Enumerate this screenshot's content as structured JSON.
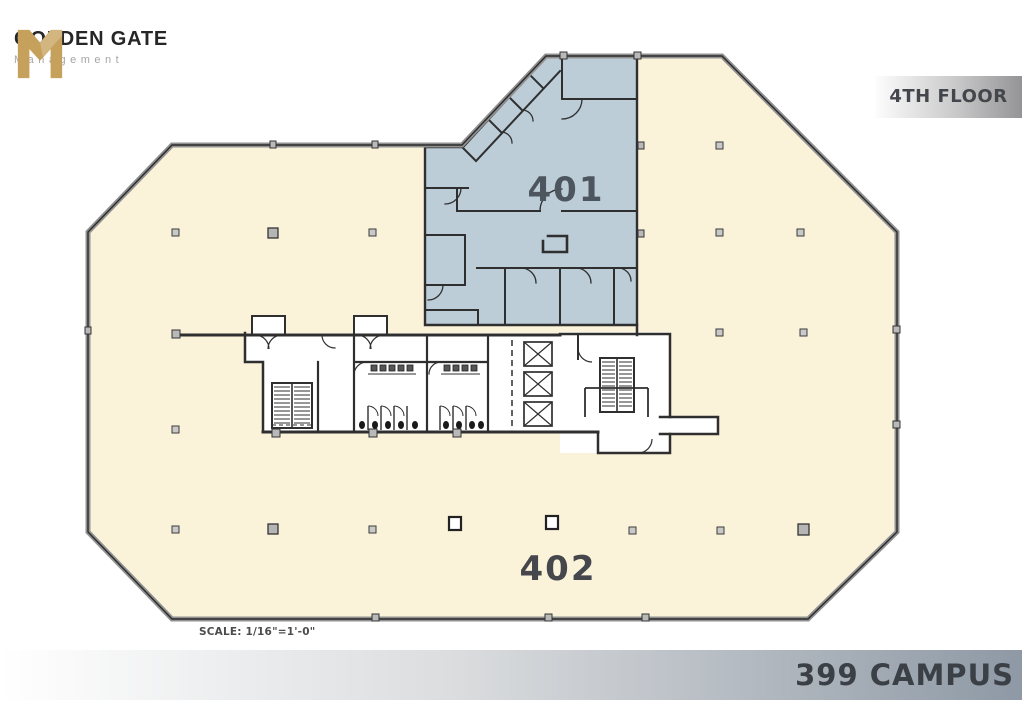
{
  "branding": {
    "company_name": "GOLDEN GATE",
    "company_subtitle": "Management"
  },
  "header": {
    "floor_label": "4TH FLOOR"
  },
  "plan": {
    "suite_401_label": "401",
    "suite_402_label": "402",
    "scale_note": "SCALE: 1/16\"=1'-0\"",
    "colors": {
      "suite_401_fill": "#bccdd8",
      "suite_402_fill": "#fbf2da",
      "wall": "#2f2f2f",
      "outer_wall_band": "#919191",
      "logo_gold": "#c6a15b"
    }
  },
  "footer": {
    "building_label": "399 CAMPUS"
  }
}
